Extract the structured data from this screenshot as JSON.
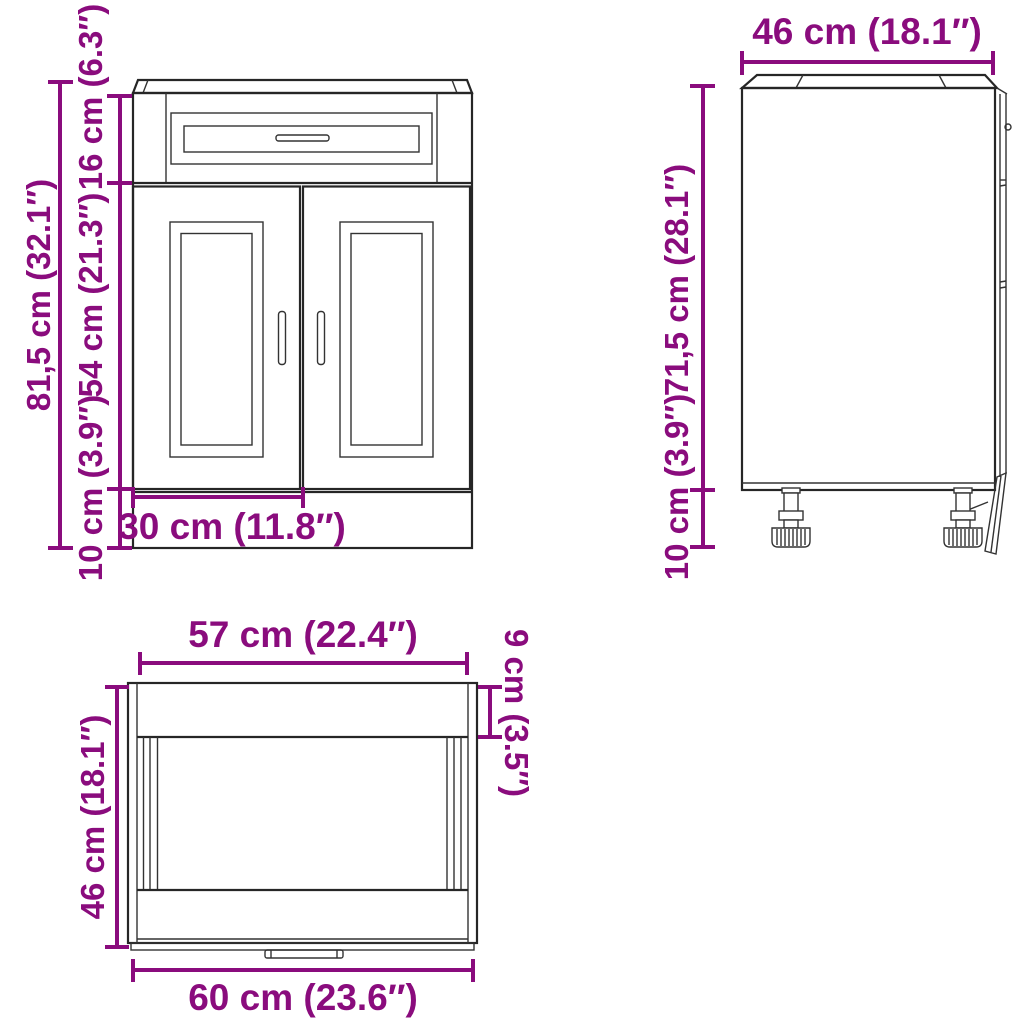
{
  "style": {
    "dimension_color": "#8A0C7D",
    "line_color": "#262626",
    "background": "#ffffff"
  },
  "diagram": {
    "type": "product-dimension-diagram",
    "subject": "kitchen base cabinet with drawer, two panel doors and adjustable feet",
    "views": {
      "front": {
        "name": "front view",
        "dimensions": {
          "total_height": "81,5 cm (32.1″)",
          "drawer_front_height": "16 cm (6.3″)",
          "door_height": "54 cm (21.3″)",
          "plinth_height": "10 cm (3.9″)",
          "door_width": "30 cm (11.8″)"
        }
      },
      "side": {
        "name": "side view",
        "dimensions": {
          "depth": "46 cm (18.1″)",
          "carcass_height": "71,5 cm (28.1″)",
          "feet_height": "10 cm (3.9″)"
        }
      },
      "top": {
        "name": "top view",
        "dimensions": {
          "inner_width": "57 cm (22.4″)",
          "front_edge_depth": "9 cm (3.5″)",
          "depth": "46 cm (18.1″)",
          "total_width": "60 cm (23.6″)"
        }
      }
    }
  }
}
